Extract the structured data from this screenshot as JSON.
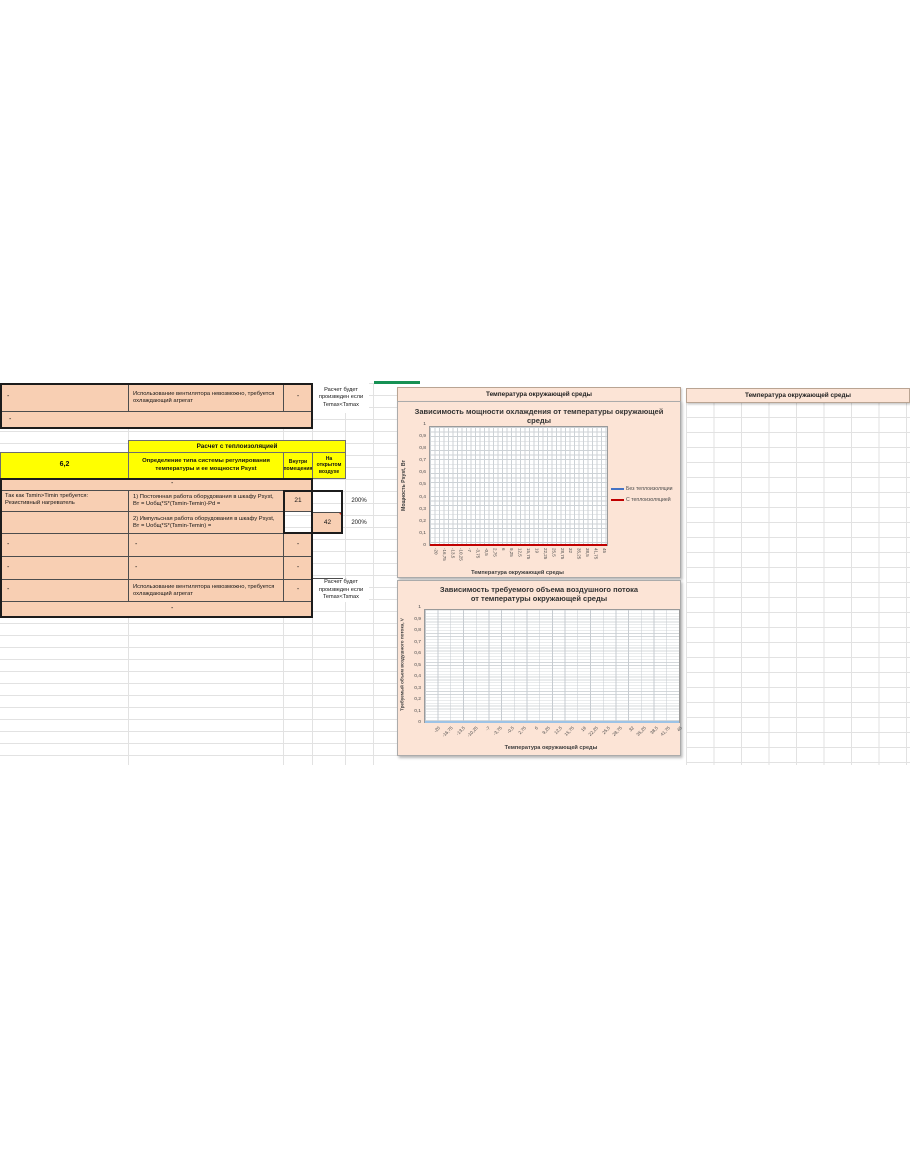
{
  "top_table": {
    "row_fan": {
      "a": "-",
      "b": "Использование вентилятора невозможно, требуется охлаждающий агрегат",
      "c": "-",
      "note": "Расчет будет произведен если Temax<Tsmax"
    },
    "row_dash": "-"
  },
  "insulation_section": {
    "band_title": "Расчет с теплоизоляцией",
    "item_number": "6,2",
    "item_title": "Определение типа системы регулирования температуры и ее мощности Psyst",
    "col_inside_header": "Внутри помещения",
    "col_outside_header": "На открытом воздухе"
  },
  "calc_table": {
    "dash_top": "-",
    "row1": {
      "a": "Так как Tsmin>Timin требуется: Резистивный нагреватель",
      "b": "1) Постоянная работа оборудования в шкафу Psyst, Вт = Uобщ*S*(Tsmin-Temin)-Pd =",
      "inside": "21",
      "outside": "42",
      "percent": "200%"
    },
    "row2": {
      "b": "2) Импульсная работа оборудования в шкафу Psyst, Вт = Uобщ*S*(Tsmin-Temin) =",
      "inside": "21",
      "outside": "42",
      "percent": "200%"
    },
    "row3": {
      "a": "-",
      "b": "-",
      "inside": "-"
    },
    "row4": {
      "a": "-",
      "b": "-",
      "inside": "-"
    },
    "row5": {
      "a": "-",
      "b": "Использование вентилятора невозможно, требуется охлаждающий агрегат",
      "inside": "-",
      "note": "Расчет будет произведен если Temax<Tsmax"
    },
    "dash_bottom": "-"
  },
  "header_bands": {
    "left": "Температура окружающей среды",
    "right": "Температура окружающей среды"
  },
  "colors": {
    "table_fill": "#f8cfb3",
    "chart_fill": "#fce4d6",
    "yellow": "#ffff00",
    "series_blue": "#4472c4",
    "series_red": "#c00000",
    "series_lightblue": "#9dc3e6",
    "selection_green": "#169154"
  },
  "chart_data": [
    {
      "type": "line",
      "title": "Зависимость мощности охлаждения от температуры окружающей среды",
      "xlabel": "Температура окружающей среды",
      "ylabel": "Мощность Psyst, Вт",
      "x": [
        -20,
        -16.75,
        -13.5,
        -10.25,
        -7,
        -3.75,
        -0.5,
        2.75,
        6,
        9.25,
        12.5,
        15.75,
        19,
        22.25,
        25.5,
        28.75,
        32,
        35.25,
        38.5,
        41.75,
        45
      ],
      "x_tick_labels": [
        "-20",
        "-16,75",
        "-13,5",
        "-10,25",
        "-7",
        "-3,75",
        "-0,5",
        "2,75",
        "6",
        "9,25",
        "12,5",
        "15,75",
        "19",
        "22,25",
        "25,5",
        "28,75",
        "32",
        "35,25",
        "38,5",
        "41,75",
        "45"
      ],
      "y_tick_labels": [
        "1",
        "0,9",
        "0,8",
        "0,7",
        "0,6",
        "0,5",
        "0,4",
        "0,3",
        "0,2",
        "0,1",
        "0"
      ],
      "ylim": [
        0,
        1
      ],
      "grid": "on",
      "legend_position": "right",
      "series": [
        {
          "name": "Без теплоизоляции",
          "color": "#4472c4",
          "values": [
            0,
            0,
            0,
            0,
            0,
            0,
            0,
            0,
            0,
            0,
            0,
            0,
            0,
            0,
            0,
            0,
            0,
            0,
            0,
            0,
            0
          ]
        },
        {
          "name": "С теплоизоляцией",
          "color": "#c00000",
          "values": [
            0,
            0,
            0,
            0,
            0,
            0,
            0,
            0,
            0,
            0,
            0,
            0,
            0,
            0,
            0,
            0,
            0,
            0,
            0,
            0,
            0
          ]
        }
      ]
    },
    {
      "type": "line",
      "title": "Зависимость требуемого объема воздушного потока от температуры окружающей среды",
      "xlabel": "Температура окружающей среды",
      "ylabel": "Требуемый объем воздушного потока, V",
      "x": [
        -20,
        -16.75,
        -13.5,
        -10.25,
        -7,
        -3.75,
        -0.5,
        2.75,
        6,
        9.25,
        12.5,
        15.75,
        19,
        22.25,
        25.5,
        28.75,
        32,
        35.25,
        38.5,
        41.75,
        45
      ],
      "x_tick_labels": [
        "-20",
        "-16,75",
        "-13,5",
        "-10,25",
        "-7",
        "-3,75",
        "-0,5",
        "2,75",
        "6",
        "9,25",
        "12,5",
        "15,75",
        "19",
        "22,25",
        "25,5",
        "28,75",
        "32",
        "35,25",
        "38,5",
        "41,75",
        "45"
      ],
      "y_tick_labels": [
        "1",
        "0,9",
        "0,8",
        "0,7",
        "0,6",
        "0,5",
        "0,4",
        "0,3",
        "0,2",
        "0,1",
        "0"
      ],
      "ylim": [
        0,
        1
      ],
      "grid": "on",
      "legend_position": "none",
      "series": [
        {
          "name": "",
          "color": "#9dc3e6",
          "values": [
            0,
            0,
            0,
            0,
            0,
            0,
            0,
            0,
            0,
            0,
            0,
            0,
            0,
            0,
            0,
            0,
            0,
            0,
            0,
            0,
            0
          ]
        }
      ]
    }
  ]
}
